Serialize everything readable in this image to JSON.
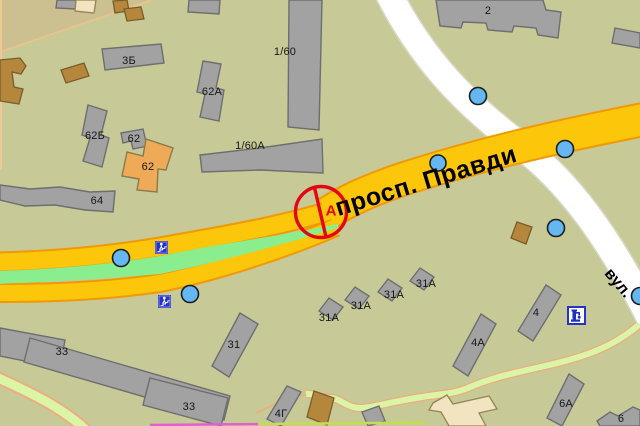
{
  "roads": {
    "primary_label": "просп. Правди",
    "secondary_label": "вул."
  },
  "marker": {
    "letter": "А",
    "type": "red-circle-slash-marker"
  },
  "building_labels": [
    {
      "text": "3Б"
    },
    {
      "text": "62А"
    },
    {
      "text": "62Б"
    },
    {
      "text": "62"
    },
    {
      "text": "62"
    },
    {
      "text": "1/60"
    },
    {
      "text": "1/60А"
    },
    {
      "text": "64"
    },
    {
      "text": "2"
    },
    {
      "text": "33"
    },
    {
      "text": "33"
    },
    {
      "text": "31"
    },
    {
      "text": "31А"
    },
    {
      "text": "31А"
    },
    {
      "text": "31А"
    },
    {
      "text": "31А"
    },
    {
      "text": "4Г"
    },
    {
      "text": "4А"
    },
    {
      "text": "4"
    },
    {
      "text": "6А"
    },
    {
      "text": "6"
    }
  ],
  "icons": {
    "crossing_icon": "underground-pedestrian-crossing",
    "pump_icon": "water-pump",
    "poi_icon": "poi-circle"
  },
  "colors": {
    "background": "#c7ca97",
    "district_tan": "#ccbf90",
    "road_primary": "#fcc60a",
    "road_primary_border": "#f09905",
    "road_secondary": "#ffffff",
    "median_green": "#8bee8e",
    "path_green": "#d9f5a5",
    "path_border_peach": "#f2a87c",
    "building_gray": "#a2a2a2",
    "building_brown": "#b5873d",
    "building_orange": "#eeaa56",
    "building_cream": "#f2e4c0",
    "poi_blue": "#65b7f1",
    "icon_blue": "#2433c9",
    "marker_red": "#e30613",
    "bottom_line_magenta": "#e25fd0",
    "bottom_line_yellowgreen": "#c6dc52"
  }
}
